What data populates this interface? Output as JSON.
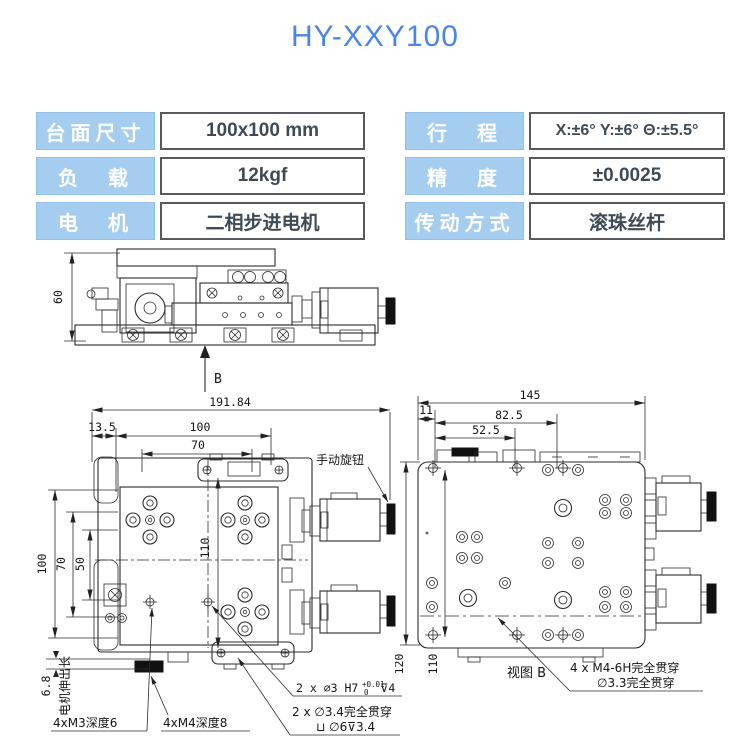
{
  "title": "HY-XXY100",
  "colors": {
    "accent": "#4a86e8",
    "spec_label_bg": "#a5cdef",
    "spec_label_text": "#ffffff",
    "spec_value_border": "#57595c",
    "spec_value_text": "#3e4b55",
    "drawing_line": "#2b2b2b"
  },
  "specs": {
    "left": [
      {
        "label": "台面尺寸",
        "value": "100x100 mm"
      },
      {
        "label": "负　载",
        "value": "12kgf"
      },
      {
        "label": "电　机",
        "value": "二相步进电机"
      }
    ],
    "right": [
      {
        "label": "行　程",
        "value": "X:±6°  Y:±6°  Θ:±5.5°"
      },
      {
        "label": "精　度",
        "value": "±0.0025"
      },
      {
        "label": "传动方式",
        "value": "滚珠丝杆"
      }
    ]
  },
  "side_view": {
    "height_dim": "60",
    "view_arrow": "B"
  },
  "plan_view": {
    "dims": {
      "overall": "191.84",
      "offset": "13.5",
      "table": "100",
      "pitch": "70",
      "v100": "100",
      "v70": "70",
      "v50": "50",
      "v110": "110",
      "motor_ext": "6.8"
    },
    "notes": {
      "knob": "手动旋钮",
      "motor_len": "电机伸出长",
      "m3": "4xM3深度6",
      "m4": "4xM4深度8",
      "pin_prefix": "2 x ∅3 H7",
      "pin_tol_up": "+0.01",
      "pin_tol_dn": "0",
      "pin_suffix": "⊽4",
      "thru_1": "2 x ∅3.4完全贯穿",
      "thru_2": "⊔ ∅6⊽3.4"
    }
  },
  "view_b": {
    "dims": {
      "w145": "145",
      "w82": "82.5",
      "w52": "52.5",
      "w11": "11",
      "v110": "110",
      "v120": "120"
    },
    "notes": {
      "title": "视图 B",
      "m4": "4 x  M4-6H完全贯穿",
      "drill": "∅3.3完全贯穿"
    }
  }
}
